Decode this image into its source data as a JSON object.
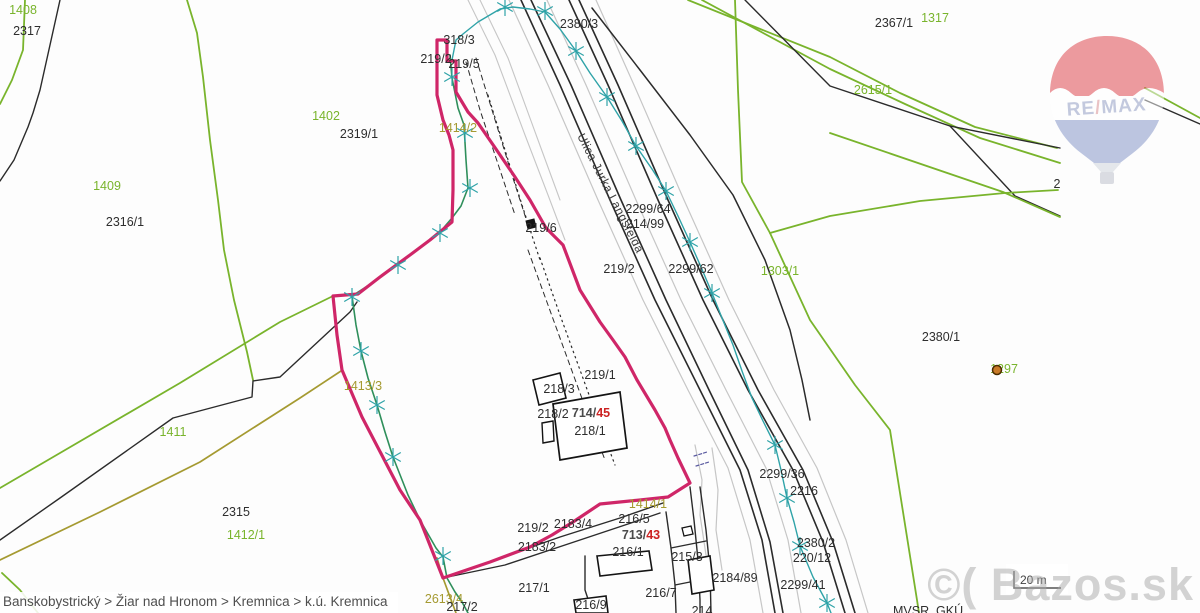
{
  "map": {
    "background": "#fdfdfd",
    "breadcrumb": "Banskobystrický > Žiar nad Hronom > Kremnica > k.ú. Kremnica",
    "attribution": "MVSR, GKÚ ...",
    "scale": {
      "label": "20 m"
    },
    "watermark": "©( Bazos.sk",
    "street": {
      "text": "Ulica Jurka Langsfelda",
      "x": 577,
      "y": 136,
      "angle": 63
    },
    "balloon": {
      "re": "RE",
      "slash": "/",
      "max": "MAX",
      "red": "#dd3a42",
      "blue": "#7d8ec5",
      "letter": "#8a97c0",
      "slash_color": "#d98b8f"
    },
    "colors": {
      "k": "#2b2b2b",
      "g": "#79b42c",
      "o": "#a59a31",
      "G": "#2f8f5b",
      "t": "#2fa3a8",
      "y": "#c6c6c6",
      "pink": "#cf2668",
      "red": "#cc2222",
      "n": "#5a5aa0",
      "label_black": "#2e2e2e",
      "dot_fill": "#c87a28",
      "dot_ring": "#4a2c00"
    },
    "labels": [
      {
        "t": "2317",
        "x": 27,
        "y": 31,
        "c": "k"
      },
      {
        "t": "1408",
        "x": 23,
        "y": 10,
        "c": "g"
      },
      {
        "t": "1402",
        "x": 326,
        "y": 116,
        "c": "g"
      },
      {
        "t": "2319/1",
        "x": 359,
        "y": 134,
        "c": "k"
      },
      {
        "t": "1409",
        "x": 107,
        "y": 186,
        "c": "g"
      },
      {
        "t": "2316/1",
        "x": 125,
        "y": 222,
        "c": "k"
      },
      {
        "t": "318/3",
        "x": 459,
        "y": 40,
        "c": "k"
      },
      {
        "t": "219/2",
        "x": 436,
        "y": 59,
        "c": "k"
      },
      {
        "t": "219/5",
        "x": 464,
        "y": 64,
        "c": "k"
      },
      {
        "t": "1414/2",
        "x": 458,
        "y": 128,
        "c": "o"
      },
      {
        "t": "2380/3",
        "x": 579,
        "y": 24,
        "c": "k"
      },
      {
        "t": "2367/1",
        "x": 894,
        "y": 23,
        "c": "k"
      },
      {
        "t": "1317",
        "x": 935,
        "y": 18,
        "c": "g"
      },
      {
        "t": "2615/1",
        "x": 873,
        "y": 90,
        "c": "g"
      },
      {
        "t": "219/6",
        "x": 541,
        "y": 228,
        "c": "k"
      },
      {
        "t": "2299/64",
        "x": 648,
        "y": 209,
        "c": "k"
      },
      {
        "t": "214/99",
        "x": 645,
        "y": 224,
        "c": "k"
      },
      {
        "t": "219/2",
        "x": 619,
        "y": 269,
        "c": "k"
      },
      {
        "t": "2299/62",
        "x": 691,
        "y": 269,
        "c": "k"
      },
      {
        "t": "1303/1",
        "x": 780,
        "y": 271,
        "c": "g"
      },
      {
        "t": "2380/1",
        "x": 941,
        "y": 337,
        "c": "k"
      },
      {
        "t": "1297",
        "x": 1004,
        "y": 369,
        "c": "g"
      },
      {
        "t": "219/1",
        "x": 600,
        "y": 375,
        "c": "k"
      },
      {
        "t": "218/3",
        "x": 559,
        "y": 389,
        "c": "k"
      },
      {
        "t": "218/2",
        "x": 553,
        "y": 414,
        "c": "k"
      },
      {
        "t": "714/45",
        "x": 591,
        "y": 413,
        "c": "k",
        "parts": [
          {
            "t": "714/",
            "c": "#4a4a4a",
            "b": true
          },
          {
            "t": "45",
            "c": "#cc2222",
            "b": true
          }
        ]
      },
      {
        "t": "218/1",
        "x": 590,
        "y": 431,
        "c": "k"
      },
      {
        "t": "1413/3",
        "x": 363,
        "y": 386,
        "c": "o"
      },
      {
        "t": "1411",
        "x": 173,
        "y": 432,
        "c": "g"
      },
      {
        "t": "2315",
        "x": 236,
        "y": 512,
        "c": "k"
      },
      {
        "t": "1412/1",
        "x": 246,
        "y": 535,
        "c": "g"
      },
      {
        "t": "219/2",
        "x": 533,
        "y": 528,
        "c": "k"
      },
      {
        "t": "2183/4",
        "x": 573,
        "y": 524,
        "c": "k"
      },
      {
        "t": "2183/2",
        "x": 537,
        "y": 547,
        "c": "k"
      },
      {
        "t": "1414/1",
        "x": 648,
        "y": 504,
        "c": "o"
      },
      {
        "t": "216/5",
        "x": 634,
        "y": 519,
        "c": "k"
      },
      {
        "t": "713/43",
        "x": 641,
        "y": 535,
        "c": "k",
        "parts": [
          {
            "t": "713/",
            "c": "#4a4a4a",
            "b": true
          },
          {
            "t": "43",
            "c": "#cc2222",
            "b": true
          }
        ]
      },
      {
        "t": "216/1",
        "x": 628,
        "y": 552,
        "c": "k"
      },
      {
        "t": "215/3",
        "x": 687,
        "y": 557,
        "c": "k"
      },
      {
        "t": "217/1",
        "x": 534,
        "y": 588,
        "c": "k"
      },
      {
        "t": "2613/4",
        "x": 444,
        "y": 599,
        "c": "o"
      },
      {
        "t": "217/2",
        "x": 462,
        "y": 607,
        "c": "k"
      },
      {
        "t": "216/9",
        "x": 591,
        "y": 605,
        "c": "k"
      },
      {
        "t": "216/7",
        "x": 661,
        "y": 593,
        "c": "k"
      },
      {
        "t": "2184/89",
        "x": 735,
        "y": 578,
        "c": "k"
      },
      {
        "t": "214",
        "x": 702,
        "y": 611,
        "c": "k"
      },
      {
        "t": "2299/36",
        "x": 782,
        "y": 474,
        "c": "k"
      },
      {
        "t": "2216",
        "x": 804,
        "y": 491,
        "c": "k"
      },
      {
        "t": "2380/2",
        "x": 816,
        "y": 543,
        "c": "k"
      },
      {
        "t": "220/12",
        "x": 812,
        "y": 558,
        "c": "k"
      },
      {
        "t": "2299/41",
        "x": 803,
        "y": 585,
        "c": "k"
      },
      {
        "t": "2",
        "x": 1057,
        "y": 184,
        "c": "k"
      },
      {
        "t": "MVSR, GKÚ ...",
        "x": 893,
        "y": 611,
        "c": "k",
        "a": "s"
      }
    ],
    "lines": [
      {
        "p": "60,0 40,90 33,113 28,127 14,160 0,181",
        "c": "k",
        "w": 1.4
      },
      {
        "p": "25,0 23,50 12,80 0,104",
        "c": "g",
        "w": 1.8
      },
      {
        "p": "187,0 197,33 203,77 210,140 218,200 224,250 234,300 247,352 253,380",
        "c": "g",
        "w": 1.8
      },
      {
        "p": "0,540 60,498 173,418 252,397 253,381 280,377 350,312 357,302",
        "c": "k",
        "w": 1.4
      },
      {
        "p": "0,488 60,453 180,383 280,322 333,296",
        "c": "g",
        "w": 1.8
      },
      {
        "p": "0,560 100,512 200,462 300,398 341,371",
        "c": "o",
        "w": 1.7
      },
      {
        "p": "2,573 20,590 38,613",
        "c": "g",
        "w": 1.8
      },
      {
        "p": "437,558 443,578 450,597 456,613",
        "c": "o",
        "w": 1.7
      },
      {
        "p": "509,0 548,85 598,200 643,300 688,390 728,468 750,540 763,613",
        "c": "y",
        "w": 1.2
      },
      {
        "p": "547,0 586,85 636,200 681,300 726,390 766,468 788,540 801,613",
        "c": "y",
        "w": 1.2
      },
      {
        "p": "596,0 634,85 684,200 729,300 774,390 817,468 846,540 868,613",
        "c": "y",
        "w": 1.2
      },
      {
        "p": "468,0 495,55 525,135 548,195 565,240",
        "c": "y",
        "w": 1.1
      },
      {
        "p": "480,0 508,58 538,140 560,200",
        "c": "y",
        "w": 1.1
      },
      {
        "p": "695,445 702,480 700,515 706,555",
        "c": "y",
        "w": 1.2
      },
      {
        "p": "712,448 718,490 716,530 722,570",
        "c": "y",
        "w": 1.2
      },
      {
        "p": "521,0 560,85 610,200 655,300 700,390 740,470 762,540 775,613",
        "c": "k",
        "w": 1.6
      },
      {
        "p": "531,0 571,85 621,200 666,300 710,392 748,470 770,542 783,613",
        "c": "k",
        "w": 1.6
      },
      {
        "p": "569,0 608,85 658,200 703,300 748,390 793,470 823,542 845,613",
        "c": "k",
        "w": 1.6
      },
      {
        "p": "579,0 618,85 668,200 713,300 758,390 803,470 833,542 855,613",
        "c": "k",
        "w": 1.6
      },
      {
        "p": "592,8 640,70 690,135 733,195 765,260 790,330 802,380 810,420",
        "c": "k",
        "w": 1.5
      },
      {
        "p": "688,0 830,57 900,93 975,127 1057,148",
        "c": "g",
        "w": 1.8
      },
      {
        "p": "702,0 830,69 905,104 980,138 1060,163",
        "c": "g",
        "w": 1.8
      },
      {
        "p": "745,0 830,86 950,126 1060,148",
        "c": "k",
        "w": 1.4
      },
      {
        "p": "950,126 1015,196 1060,216",
        "c": "k",
        "w": 1.4
      },
      {
        "p": "830,133 1003,192 1060,217",
        "c": "g",
        "w": 1.8
      },
      {
        "p": "735,0 738,90 742,182 770,233",
        "c": "g",
        "w": 1.8
      },
      {
        "p": "770,233 830,216 920,201 1005,193 1058,190",
        "c": "g",
        "w": 1.8
      },
      {
        "p": "770,233 810,320 855,385 890,430 917,600 919,613",
        "c": "g",
        "w": 1.8
      },
      {
        "p": "1145,88 1200,118",
        "c": "g",
        "w": 1.8
      },
      {
        "p": "1145,100 1200,124",
        "c": "k",
        "w": 1.4
      },
      {
        "p": "443,578 500,558 560,537 620,518 663,503",
        "c": "k",
        "w": 1.4
      },
      {
        "p": "443,578 505,565 565,545 625,525 660,513",
        "c": "k",
        "w": 1.4
      },
      {
        "p": "585,556 585,590 590,605 594,613",
        "c": "k",
        "w": 1.4
      },
      {
        "p": "666,512 671,548 675,585 676,613",
        "c": "k",
        "w": 1.4
      },
      {
        "p": "700,487 706,530 710,570 711,613",
        "c": "k",
        "w": 1.4
      },
      {
        "p": "671,548 706,541",
        "c": "k",
        "w": 1.2
      },
      {
        "p": "675,585 710,578",
        "c": "k",
        "w": 1.2
      },
      {
        "p": "690,487 694,520 698,560 700,600 700,613",
        "c": "k",
        "w": 1.4
      },
      {
        "p": "466,62 480,110 500,170 515,215",
        "c": "k",
        "w": 1,
        "dash": "5 4"
      },
      {
        "p": "476,58 492,110 512,175 528,225",
        "c": "k",
        "w": 1,
        "dash": "5 4"
      },
      {
        "p": "488,95 505,150 522,205 540,260",
        "c": "k",
        "w": 1.2,
        "dash": "1.5 4"
      },
      {
        "p": "528,250 548,305 568,360 588,415 605,460",
        "c": "k",
        "w": 1,
        "dash": "5 4"
      },
      {
        "p": "540,258 560,315 580,370 600,425 615,465",
        "c": "k",
        "w": 1.2,
        "dash": "1.5 4"
      },
      {
        "p": "694,456 707,452",
        "c": "n",
        "w": 1.2,
        "dash": "3 2"
      },
      {
        "p": "696,466 709,462",
        "c": "n",
        "w": 1.2,
        "dash": "3 2"
      },
      {
        "p": "450,55 452,78 458,108 464,125 466,160 468,188 461,206 452,218 440,232 420,247 398,264 375,281 352,296 356,325 361,351 368,378 377,405 385,432 393,457 408,495 420,520 436,548 443,557 447,578 455,592 462,602 468,613",
        "c": "G",
        "w": 1.6
      },
      {
        "p": "452,60 456,40 463,34 478,22 500,9 513,7 530,9 545,12 560,29 576,51 590,73 607,97 622,121 636,146 652,169 666,191 678,216 690,242 701,267 712,293 722,318 733,345 742,371 752,398 763,421 775,445 781,470 787,498 794,522 800,546 813,577 827,603 831,613",
        "c": "t",
        "w": 1.4
      }
    ],
    "polygons": [
      {
        "p": "533,380 560,373 566,398 539,405",
        "f": "#ffffff",
        "s": "#141414",
        "w": 1.6
      },
      {
        "p": "553,404 620,392 627,448 560,460",
        "f": "#ffffff",
        "s": "#141414",
        "w": 1.7
      },
      {
        "p": "542,423 553,421 554,441 543,443",
        "f": "#ffffff",
        "s": "#141414",
        "w": 1.4
      },
      {
        "p": "597,556 649,551 652,570 600,576",
        "f": "#ffffff",
        "s": "#141414",
        "w": 1.6
      },
      {
        "p": "688,560 710,556 714,590 692,594",
        "f": "#ffffff",
        "s": "#141414",
        "w": 1.6
      },
      {
        "p": "574,600 606,596 608,613 576,613",
        "f": "#ffffff",
        "s": "#141414",
        "w": 1.6
      },
      {
        "p": "682,528 691,526 693,534 684,536",
        "f": "#ffffff",
        "s": "#141414",
        "w": 1.3
      },
      {
        "p": "526,221 534,219 536,227 528,229",
        "f": "#141414",
        "s": "#141414",
        "w": 1
      }
    ],
    "highlight_parcel": {
      "p": "437,95 437,40 447,40 447,61 456,61 456,92 468,112 478,123 498,152 515,177 530,200 546,228 563,245 580,290 600,322 613,340 625,357 637,380 655,410 665,428 670,440 678,458 690,483 668,497 640,500 600,504 573,522 552,535 530,547 490,562 443,578 420,520 400,490 362,417 342,370 337,335 333,296 358,294 380,277 410,255 430,240 452,222 453,190 453,150 449,135 443,120",
      "stroke": "#cf2668",
      "w": 3.2
    },
    "stars": [
      [
        505,
        7
      ],
      [
        545,
        11
      ],
      [
        576,
        51
      ],
      [
        607,
        97
      ],
      [
        636,
        146
      ],
      [
        666,
        191
      ],
      [
        690,
        242
      ],
      [
        712,
        293
      ],
      [
        775,
        445
      ],
      [
        787,
        498
      ],
      [
        800,
        546
      ],
      [
        827,
        603
      ],
      [
        452,
        77
      ],
      [
        465,
        133
      ],
      [
        470,
        188
      ],
      [
        440,
        233
      ],
      [
        398,
        265
      ],
      [
        352,
        297
      ],
      [
        361,
        351
      ],
      [
        377,
        405
      ],
      [
        393,
        457
      ],
      [
        443,
        556
      ]
    ],
    "dot": {
      "x": 997,
      "y": 370,
      "r": 4.5
    }
  }
}
